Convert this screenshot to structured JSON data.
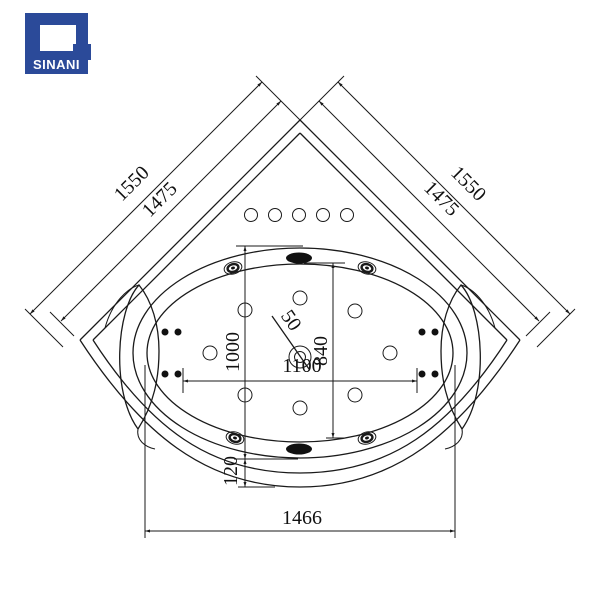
{
  "logo": {
    "brand": "SINANI",
    "bg_color": "#2b4a99",
    "text_color": "#ffffff"
  },
  "drawing": {
    "type": "corner-bathtub-top-view-technical-drawing",
    "line_color": "#1a1a1a",
    "dimensions": {
      "side_outer": "1550",
      "side_inner": "1475",
      "rim_height": "1000",
      "basin_height": "840",
      "basin_length": "1100",
      "drain_diameter": "50",
      "front_lip": "120",
      "front_width": "1466"
    },
    "features": {
      "deck_air_circle_count": 5,
      "floor_jet_count": 8,
      "side_microjet_count": 8,
      "wall_jet_fixture_count": 4,
      "suction_oval_count": 2
    }
  }
}
